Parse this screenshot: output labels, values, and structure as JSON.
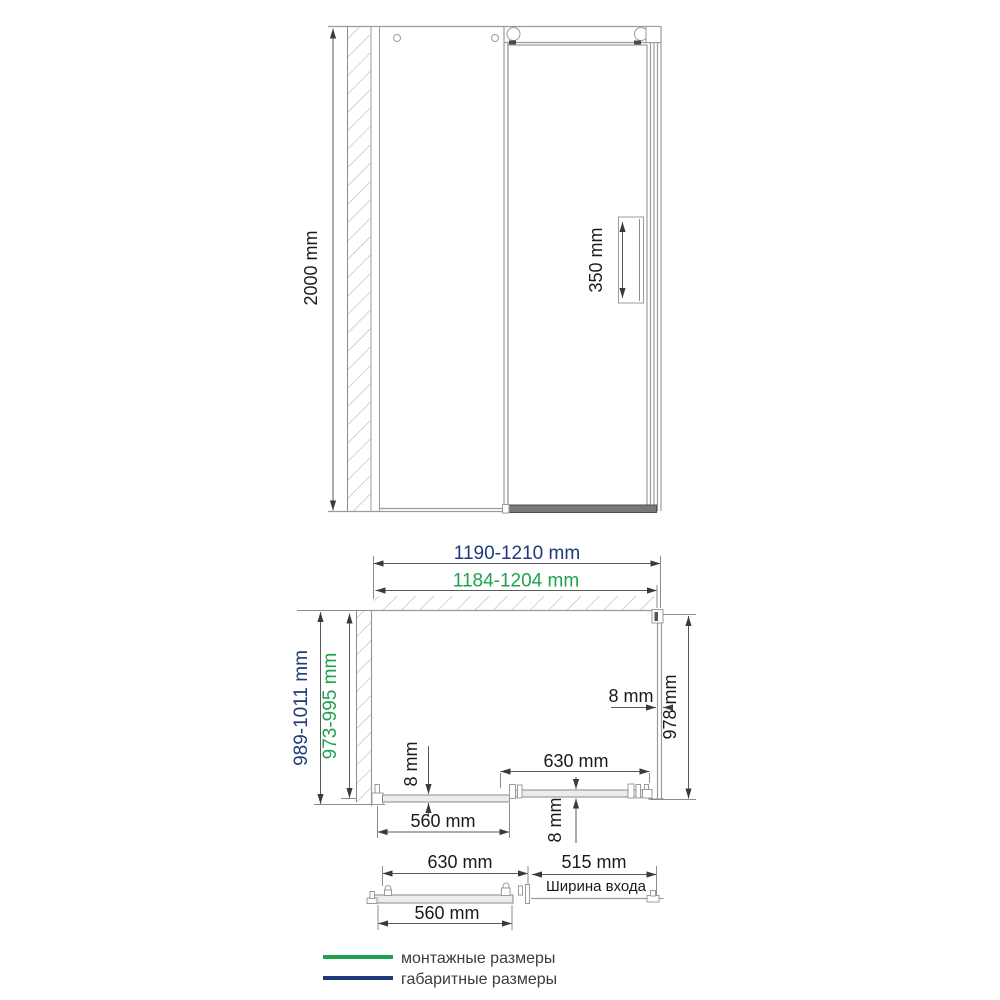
{
  "drawing": {
    "title": "Shower enclosure dimensional drawing",
    "colors": {
      "overall": "#1e3a78",
      "mounting": "#1fa24e",
      "line": "#9b9b9b",
      "dim_line": "#5a5a5a",
      "arrow": "#3a3a3a",
      "text": "#1a1a1a",
      "legend_text": "#3c3c3c"
    },
    "front_view": {
      "height": "2000 mm",
      "handle": "350 mm"
    },
    "plan_view": {
      "overall_width": "1190-1210 mm",
      "mounting_width": "1184-1204 mm",
      "overall_depth": "989-1011 mm",
      "mounting_depth": "973-995 mm",
      "side_glass_thickness": "8 mm",
      "side_panel_depth": "978 mm",
      "fixed_glass_thickness": "8 mm",
      "door_width": "630 mm",
      "door_glass_thickness": "8 mm",
      "fixed_panel_width": "560 mm"
    },
    "open_view": {
      "door_width": "630 mm",
      "entry_width": "515 mm",
      "entry_caption": "Ширина входа",
      "fixed_panel_width": "560 mm"
    },
    "legend": [
      {
        "label": "монтажные размеры",
        "color": "#1fa24e"
      },
      {
        "label": "габаритные размеры",
        "color": "#1e3a78"
      }
    ]
  }
}
